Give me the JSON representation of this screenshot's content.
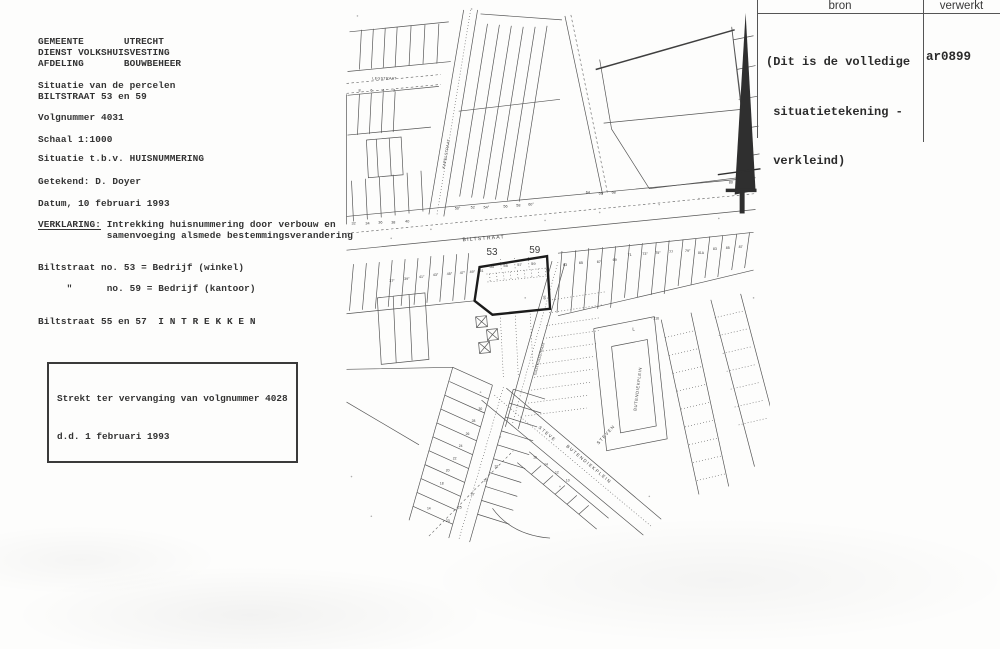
{
  "colors": {
    "paper": "#fdfdfc",
    "ink": "#333333",
    "map_line": "#4f4f4f",
    "bold_parcel": "#1b1b1b"
  },
  "left_panel": {
    "agency_lines": [
      "GEMEENTE       UTRECHT",
      "DIENST VOLKSHUISVESTING",
      "AFDELING       BOUWBEHEER"
    ],
    "subject_lines": [
      "Situatie van de percelen",
      "BILTSTRAAT 53 en 59"
    ],
    "volgnummer": "Volgnummer 4031",
    "schaal": "Schaal 1:1000",
    "situatie": "Situatie t.b.v. HUISNUMMERING",
    "getekend": "Getekend: D. Doyer",
    "datum": "Datum, 10 februari 1993",
    "verklaring_label": "VERKLARING:",
    "verklaring_line1": " Intrekking huisnummering door verbouw en",
    "verklaring_line2": "            samenvoeging alsmede bestemmingsverandering",
    "usage_line1": "Biltstraat no. 53 = Bedrijf (winkel)",
    "usage_line2": "     \"      no. 59 = Bedrijf (kantoor)",
    "intrekken_line": "Biltstraat 55 en 57  I N T R E K K E N",
    "replacement_box": [
      "Strekt ter vervanging van volgnummer 4028",
      "d.d. 1 februari 1993"
    ]
  },
  "header_table": {
    "col1": "bron",
    "col2": "verwerkt",
    "note_lines": [
      "(Dit is de volledige",
      " situatietekening -",
      " verkleind)"
    ],
    "code": "ar0899"
  },
  "map": {
    "labels": [
      {
        "t": "LEGSTRAAT",
        "x": 371,
        "y": 80,
        "s": 3.6,
        "ls": 0.4
      },
      {
        "t": "8",
        "x": 357,
        "y": 92,
        "s": 3.8
      },
      {
        "t": "6",
        "x": 369,
        "y": 92,
        "s": 3.8
      },
      {
        "t": "4",
        "x": 381,
        "y": 92,
        "s": 3.8
      },
      {
        "t": "2",
        "x": 392,
        "y": 92,
        "s": 3.8
      },
      {
        "t": "KAPELSTRAAT",
        "x": 444,
        "y": 170,
        "s": 3.8,
        "r": -80,
        "ls": 0.3
      },
      {
        "t": "50°",
        "x": 454,
        "y": 211,
        "s": 3.8
      },
      {
        "t": "52",
        "x": 470,
        "y": 210,
        "s": 3.8
      },
      {
        "t": "54°",
        "x": 483,
        "y": 210,
        "s": 3.8
      },
      {
        "t": "56",
        "x": 503,
        "y": 209,
        "s": 3.8
      },
      {
        "t": "58",
        "x": 516,
        "y": 208,
        "s": 3.8
      },
      {
        "t": "60°",
        "x": 528,
        "y": 207,
        "s": 3.8
      },
      {
        "t": "64",
        "x": 586,
        "y": 195,
        "s": 3.8
      },
      {
        "t": "66",
        "x": 599,
        "y": 196,
        "s": 3.8
      },
      {
        "t": "68",
        "x": 612,
        "y": 195,
        "s": 3.8
      },
      {
        "t": "32",
        "x": 350,
        "y": 226,
        "s": 3.8
      },
      {
        "t": "34",
        "x": 364,
        "y": 226,
        "s": 3.8
      },
      {
        "t": "36",
        "x": 377,
        "y": 225,
        "s": 3.8
      },
      {
        "t": "38",
        "x": 390,
        "y": 225,
        "s": 3.8
      },
      {
        "t": "40",
        "x": 404,
        "y": 224,
        "s": 3.8
      },
      {
        "t": "BILTSTRAAT",
        "x": 462,
        "y": 243,
        "s": 5.2,
        "r": -4,
        "ls": 1.2
      },
      {
        "t": "37°",
        "x": 388,
        "y": 284,
        "s": 3.6
      },
      {
        "t": "39°",
        "x": 403,
        "y": 282,
        "s": 3.6
      },
      {
        "t": "41°",
        "x": 418,
        "y": 280,
        "s": 3.6
      },
      {
        "t": "43°",
        "x": 432,
        "y": 278,
        "s": 3.6
      },
      {
        "t": "45°",
        "x": 446,
        "y": 277,
        "s": 3.6
      },
      {
        "t": "47°",
        "x": 459,
        "y": 276,
        "s": 3.6
      },
      {
        "t": "49°",
        "x": 469,
        "y": 275,
        "s": 3.6
      },
      {
        "t": "51",
        "x": 479,
        "y": 274,
        "s": 3.6
      },
      {
        "t": "53",
        "x": 486,
        "y": 257,
        "s": 10
      },
      {
        "t": "59",
        "x": 529,
        "y": 255,
        "s": 10
      },
      {
        "t": "53",
        "x": 489,
        "y": 270,
        "s": 4
      },
      {
        "t": "55",
        "x": 503,
        "y": 269,
        "s": 4
      },
      {
        "t": "57",
        "x": 517,
        "y": 268,
        "s": 4
      },
      {
        "t": "59",
        "x": 531,
        "y": 267,
        "s": 4
      },
      {
        "t": "59",
        "x": 546,
        "y": 271,
        "s": 3.4,
        "r": 80
      },
      {
        "t": "59",
        "x": 543,
        "y": 298,
        "s": 3.4,
        "r": 80
      },
      {
        "t": "63",
        "x": 563,
        "y": 268,
        "s": 3.8
      },
      {
        "t": "65",
        "x": 579,
        "y": 266,
        "s": 3.8
      },
      {
        "t": "67",
        "x": 597,
        "y": 265,
        "s": 3.8
      },
      {
        "t": "69",
        "x": 613,
        "y": 263,
        "s": 3.8
      },
      {
        "t": "71",
        "x": 628,
        "y": 258,
        "s": 3.8
      },
      {
        "t": "73°",
        "x": 643,
        "y": 257,
        "s": 3.6
      },
      {
        "t": "75°",
        "x": 656,
        "y": 256,
        "s": 3.6
      },
      {
        "t": "77",
        "x": 670,
        "y": 255,
        "s": 3.6
      },
      {
        "t": "79°",
        "x": 686,
        "y": 254,
        "s": 3.6
      },
      {
        "t": "81A",
        "x": 699,
        "y": 256,
        "s": 3.4
      },
      {
        "t": "83",
        "x": 714,
        "y": 252,
        "s": 3.6
      },
      {
        "t": "85",
        "x": 727,
        "y": 251,
        "s": 3.6
      },
      {
        "t": "87",
        "x": 740,
        "y": 250,
        "s": 3.6
      },
      {
        "t": "80",
        "x": 730,
        "y": 185,
        "s": 3.8
      },
      {
        "t": "GASTHUISSTRAAT",
        "x": 536,
        "y": 378,
        "s": 3.5,
        "r": -75,
        "ls": 0.2
      },
      {
        "t": "L",
        "x": 633,
        "y": 333,
        "s": 4.5
      },
      {
        "t": "- 216",
        "x": 652,
        "y": 322,
        "s": 3.4
      },
      {
        "t": "BUTENDIEKPLEIN",
        "x": 637,
        "y": 414,
        "s": 4.2,
        "r": -83,
        "ls": 0.6
      },
      {
        "t": "STEVEN",
        "x": 599,
        "y": 448,
        "s": 4.5,
        "r": -48,
        "ls": 1.2
      },
      {
        "t": "STEVE",
        "x": 538,
        "y": 431,
        "s": 4.5,
        "r": 40,
        "ls": 1.4
      },
      {
        "t": "BUTENDIEKPLEIN",
        "x": 566,
        "y": 450,
        "s": 4.5,
        "r": 40,
        "ls": 1.4
      },
      {
        "t": "23",
        "x": 445,
        "y": 526,
        "s": 3.6
      },
      {
        "t": "25",
        "x": 457,
        "y": 512,
        "s": 3.6
      },
      {
        "t": "27",
        "x": 470,
        "y": 499,
        "s": 3.6
      },
      {
        "t": "29",
        "x": 483,
        "y": 485,
        "s": 3.6
      },
      {
        "t": "31",
        "x": 494,
        "y": 471,
        "s": 3.6
      },
      {
        "t": "30",
        "x": 478,
        "y": 413,
        "s": 3.4
      },
      {
        "t": "28",
        "x": 471,
        "y": 425,
        "s": 3.4
      },
      {
        "t": "26",
        "x": 465,
        "y": 438,
        "s": 3.4
      },
      {
        "t": "24",
        "x": 458,
        "y": 450,
        "s": 3.4
      },
      {
        "t": "22",
        "x": 452,
        "y": 463,
        "s": 3.4
      },
      {
        "t": "20",
        "x": 445,
        "y": 475,
        "s": 3.4
      },
      {
        "t": "18",
        "x": 439,
        "y": 488,
        "s": 3.4
      },
      {
        "t": "14",
        "x": 426,
        "y": 513,
        "s": 3.4
      },
      {
        "t": "16",
        "x": 533,
        "y": 462,
        "s": 3.4
      },
      {
        "t": "14",
        "x": 544,
        "y": 469,
        "s": 3.4
      },
      {
        "t": "12",
        "x": 555,
        "y": 477,
        "s": 3.4
      },
      {
        "t": "10",
        "x": 566,
        "y": 485,
        "s": 3.4
      }
    ]
  }
}
